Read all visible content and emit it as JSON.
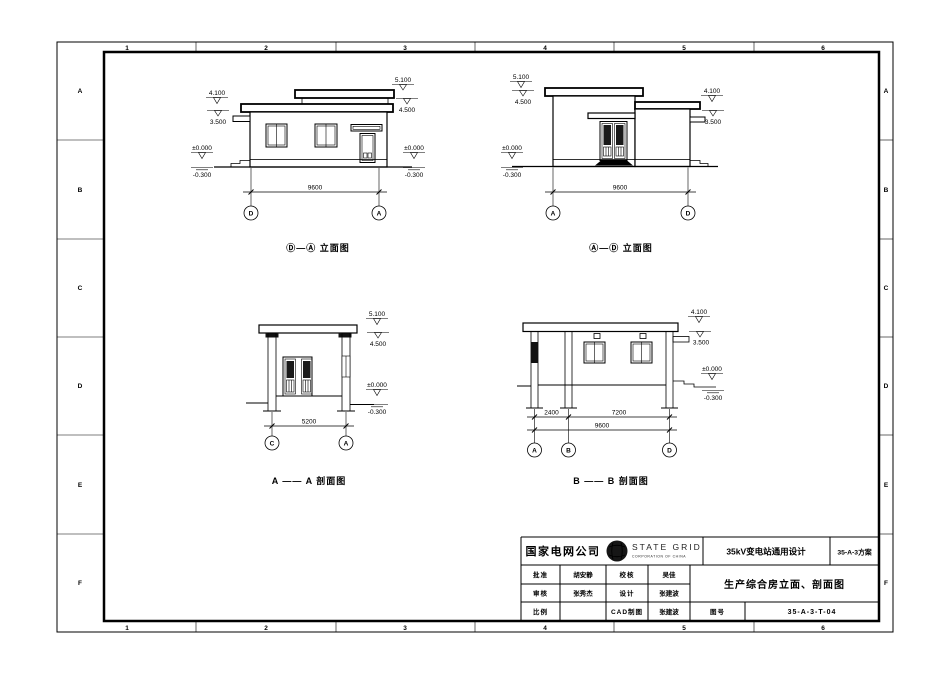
{
  "frame": {
    "cols": [
      "1",
      "2",
      "3",
      "4",
      "5",
      "6"
    ],
    "rows": [
      "A",
      "B",
      "C",
      "D",
      "E",
      "F"
    ]
  },
  "levels": {
    "v5_100": "5.100",
    "v4_500": "4.500",
    "v4_100": "4.100",
    "v3_500": "3.500",
    "v0_000": "±0.000",
    "vm0_300": "-0.300"
  },
  "dims": {
    "d9600": "9600",
    "d5200": "5200",
    "d2400": "2400",
    "d7200": "7200"
  },
  "grids": {
    "a": "A",
    "b": "B",
    "c": "C",
    "d": "D"
  },
  "captions": {
    "elev_da": "Ⓓ—Ⓐ 立面图",
    "elev_ad": "Ⓐ—Ⓓ 立面图",
    "sec_aa": "A —— A 剖面图",
    "sec_bb": "B —— B 剖面图"
  },
  "titleblock": {
    "company": "国家电网公司",
    "brand": "STATE GRID",
    "brand_sub": "CORPORATION OF CHINA",
    "project": "35kV变电站通用设计",
    "scheme": "35-A-3方案",
    "title": "生产综合房立面、剖面图",
    "fields": {
      "approve_label": "批准",
      "approve": "胡安静",
      "check_label": "校核",
      "check": "吴佳",
      "review_label": "审核",
      "review": "张秀杰",
      "design_label": "设计",
      "design": "张建波",
      "scale_label": "比例",
      "scale": "",
      "cad_label": "CAD制图",
      "cad": "张建波",
      "no_label": "图号",
      "no": "35-A-3-T-04"
    }
  }
}
